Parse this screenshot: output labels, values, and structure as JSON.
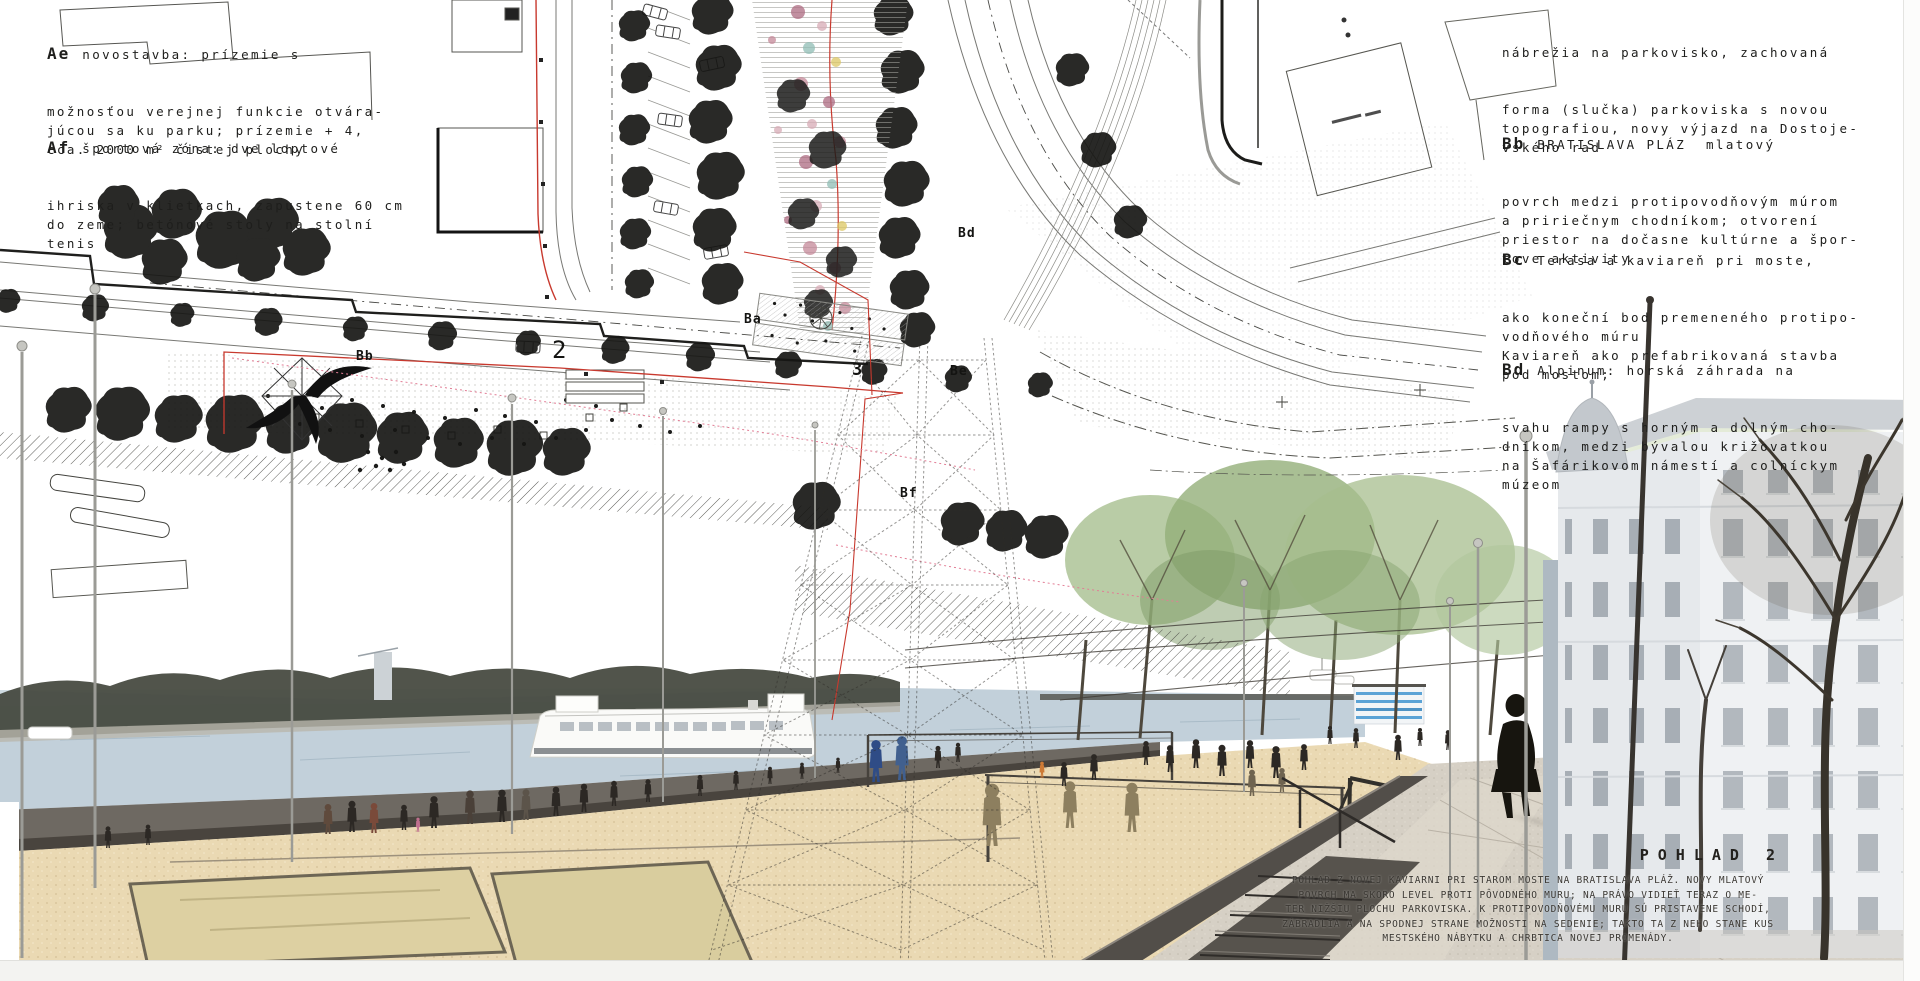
{
  "panel": {
    "background": "#ffffff",
    "accent_red": "#c8392e"
  },
  "left_notes": [
    {
      "code": "Ae",
      "first": "novostavba: prízemie s",
      "rest": [
        "možnosťou verejnej funkcie otvára-",
        "júcou sa ku parku; prízemie + 4,",
        "cca. 2000 m² čistej plochy"
      ]
    },
    {
      "code": "Af",
      "first": "športová zóna: dve loptové",
      "rest": [
        "ihriska v klietkach, zapustene 60 cm",
        "do zeme; betónové stoly na stolní",
        "tenis"
      ]
    }
  ],
  "right_notes": [
    {
      "code": "",
      "first": "nábrežia na parkovisko, zachovaná",
      "rest": [
        "forma (slučka) parkoviska s novou",
        "topografiou, novy výjazd na Dostoje-",
        "vského rad"
      ]
    },
    {
      "code": "Bb",
      "first": "BRATISLAVA PLÁZ  mlatový",
      "rest": [
        "povrch medzi protipovodňovým múrom",
        "a pririečnym chodníkom; otvorení",
        "priestor na dočasne kultúrne a špor-",
        "tove aktivity"
      ]
    },
    {
      "code": "Bc",
      "first": "Terasa a kaviareň pri moste,",
      "rest": [
        "ako koneční bod premeneného protipo-",
        "vodňového múru",
        "Kaviareň ako prefabrikovaná stavba",
        "pod mostom;"
      ]
    },
    {
      "code": "Bd",
      "first": "Alpinum: horská záhrada na",
      "rest": [
        "svahu rampy s horným a dolným cho-",
        "dníkom, medzi bývalou križovatkou",
        "na Šafárikovom námestí a colníckym",
        "múzeom"
      ]
    }
  ],
  "plan_labels": {
    "ba": "Ba",
    "bb": "Bb",
    "bd": "Bd",
    "be": "Be",
    "bf": "Bf",
    "n2": "2",
    "n3": "3"
  },
  "caption": {
    "title": "POHLAD 2",
    "lines": [
      "POHLAD Z NOVEJ KAVIARNI PRI STAROM MOSTE NA BRATISLAVA PLÁŽ. NOVY MLATOVÝ",
      "POVRCH MA SKORO LEVEL PROTI PÔVODNÉHO MURU; NA PRÁVO VIDIEŤ TERAZ O ME-",
      "TER NIŽŠIU PLOCHU PARKOVISKA. K PROTIPOVODŇOVÉMU MURU SÚ PRISTAVENE SCHODÍ,",
      "ZÁBRADLIA A NA SPODNEJ STRANE MOŽNOSTI NA SEDENIE; TAKTO TA Z NEHO STANE KUS",
      "MESTSKÉHO NÁBYTKU A CHRBTICA NOVEJ PROMENÁDY."
    ]
  }
}
